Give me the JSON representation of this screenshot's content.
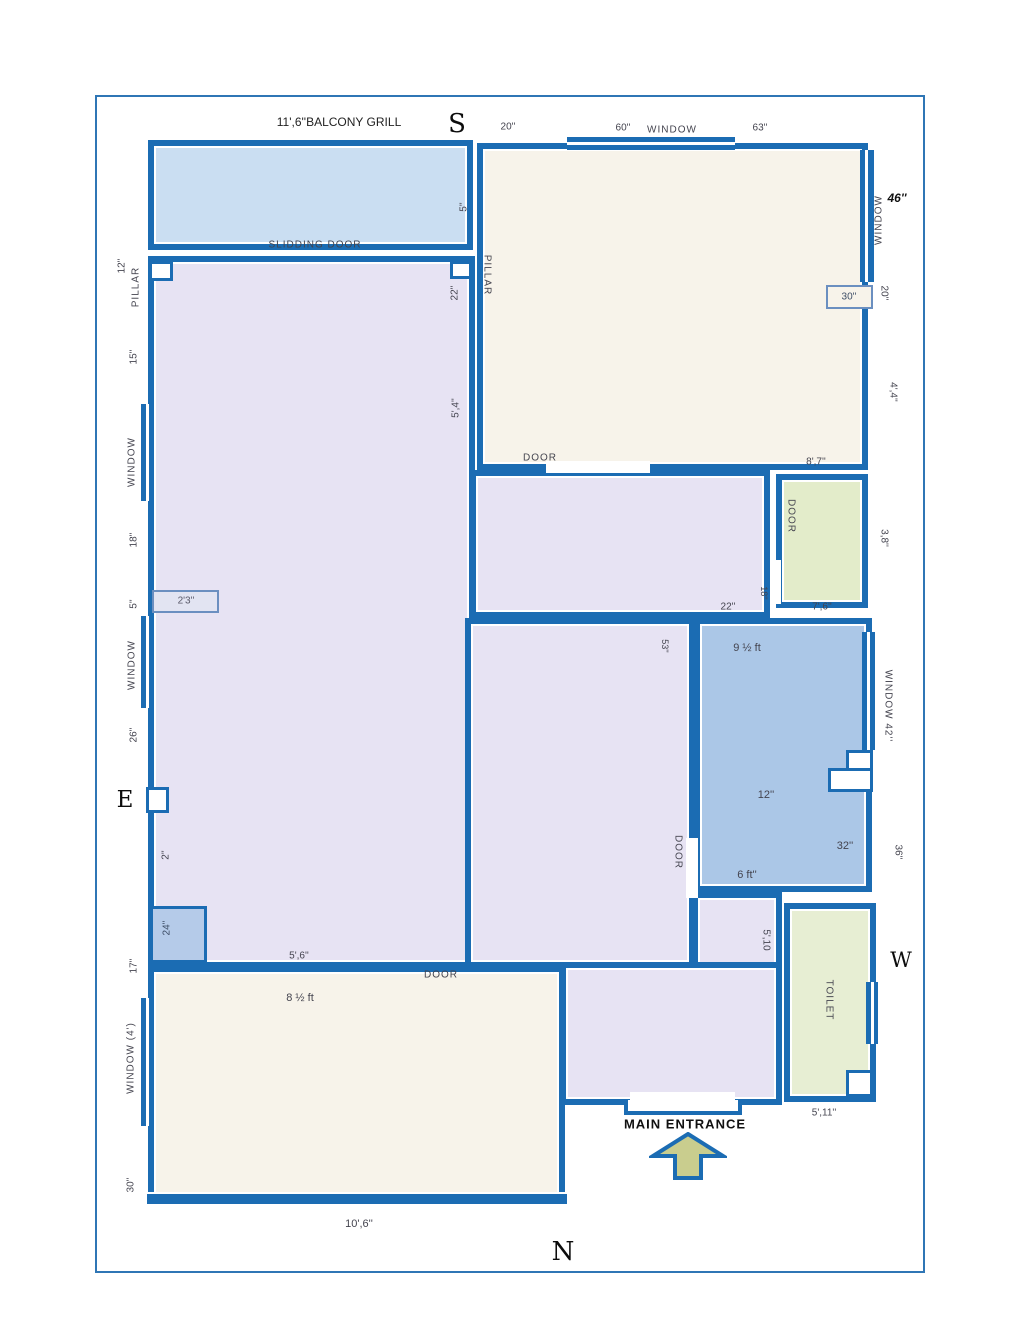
{
  "compass": {
    "south": "S",
    "north": "N",
    "east": "E",
    "west": "W"
  },
  "colors": {
    "wall": "#1b6cb3",
    "frame": "#2f76b5",
    "balcony_fill": "#cadef2",
    "lavender_fill": "#e7e3f3",
    "beige_fill": "#f7f3ea",
    "green_fill": "#e3ecca",
    "blue_room_fill": "#abc7e7",
    "toilet_fill": "#e7eed3",
    "arrow_fill": "#c9cd8e",
    "box_fill": "#b5cbe9"
  },
  "top": {
    "grill": "11',6''BALCONY GRILL",
    "d20": "20''",
    "d60": "60''",
    "window": "WINDOW",
    "d63": "63''"
  },
  "balcony": {
    "slidding": "SLIDDING DOOR",
    "d5": "5''"
  },
  "leftwall": {
    "d12": "12''",
    "pillar": "PILLAR",
    "d15": "15''",
    "window1": "WINDOW",
    "d18": "18''",
    "d5": "5''",
    "box23": "2'3''",
    "window2": "WINDOW",
    "d26": "26''",
    "d2": "2''",
    "box24": "24''",
    "d17": "17''",
    "window4": "WINDOW  (4')",
    "d30": "30''"
  },
  "living": {
    "pillar": "PILLAR",
    "d22": "22''",
    "d54": "5',4''",
    "d56": "5',6''"
  },
  "topright": {
    "window": "WINDOW",
    "d46": "46''",
    "d20": "20''",
    "box30": "30''",
    "d44": "4',4''",
    "door": "DOOR",
    "d87": "8',7''"
  },
  "mid": {
    "d22": "22''",
    "d18": "18''",
    "doorg": "DOOR",
    "d76": "7',6''",
    "d38": "3,8''",
    "d53": "53''",
    "door": "DOOR"
  },
  "blue": {
    "d9h": "9 ½ ft",
    "d12": "12''",
    "d32": "32''",
    "d6ft": "6 ft''",
    "win42": "WINDOW 42''",
    "d36": "36''"
  },
  "bottom": {
    "door": "DOOR",
    "d8h": "8 ½ ft",
    "d106": "10',6''",
    "entrance": "MAIN ENTRANCE"
  },
  "toilet": {
    "label": "TOILET",
    "d511": "5',11''",
    "d510": "5',10"
  }
}
